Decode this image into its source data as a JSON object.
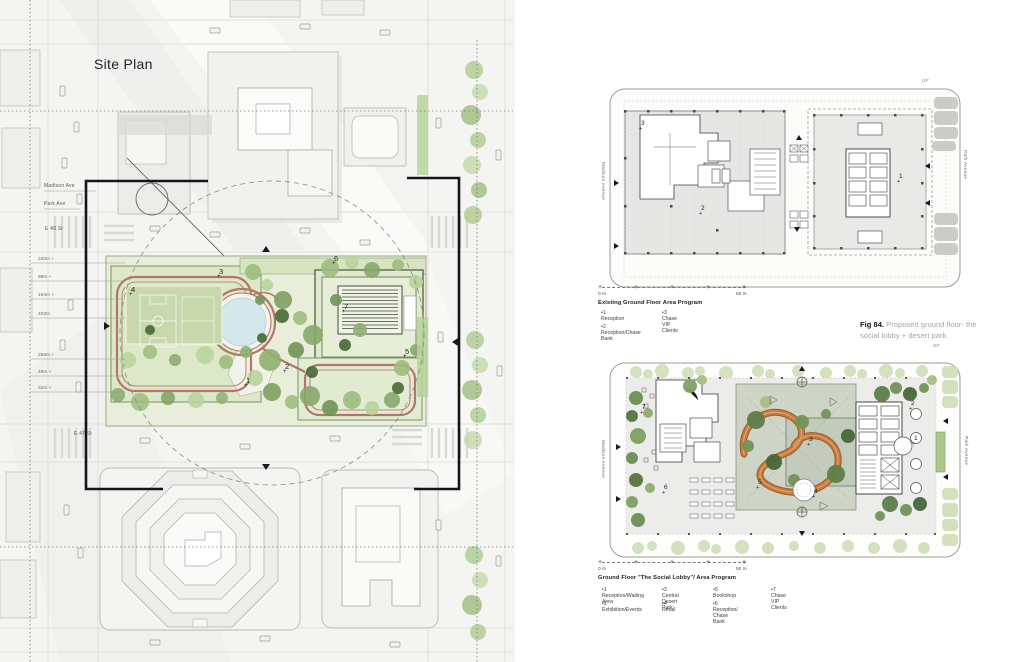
{
  "site_plan": {
    "title": "Site Plan",
    "streets": {
      "madison_ave": "Madison Ave",
      "park_ave": "Park Ave",
      "e48": "E 48 St",
      "e47": "E 47 St"
    },
    "elevations": [
      "340m +",
      "98m +",
      "164m +",
      "403m",
      "256m +",
      "48m +",
      "32m +"
    ],
    "markers": {
      "m1": "1",
      "m2": "2",
      "m3": "3",
      "m4": "4",
      "m5": "5",
      "m6": "6",
      "m7": "7"
    }
  },
  "existing_plan": {
    "floor_tag": "GF",
    "street_left": "Madison Avenue",
    "street_right": "Park Avenue",
    "markers": {
      "m1": "1",
      "m2": "2",
      "m3": "3"
    },
    "scale_start": "0 m",
    "scale_end": "50 m",
    "caption": "Existing Ground Floor Area Program",
    "legend": {
      "item1": "•1 Reception",
      "item2": "•2 Reception/Chase Bank",
      "item3": "•3 Chase VIP Clients"
    }
  },
  "figure": {
    "label": "Fig 84.",
    "text": " Proposed ground floor- the social lobby + desert park."
  },
  "proposed_plan": {
    "floor_tag": "GF",
    "street_left": "Madison Avenue",
    "street_right": "Park Avenue",
    "markers": {
      "m1": "1",
      "m2": "2",
      "m3": "3",
      "m4": "4",
      "m5": "5",
      "m6": "6",
      "m7": "7"
    },
    "scale_start": "0 m",
    "scale_end": "50 m",
    "caption": "Ground Floor \"The Social Lobby\"/ Area Program",
    "legend_row1": {
      "item1": "•1 Reception/Waiting Area",
      "item3": "•3 Central Desert Park",
      "item5": "•5 Bookshop",
      "item7": "•7 Chase VIP Clients"
    },
    "legend_row2": {
      "item2": "•2 Exhibition/Events",
      "item4": "•4 Retail",
      "item6": "•6 Reception/ Chase Bank"
    }
  },
  "colors": {
    "track": "#b4756c",
    "ramp": "#c57a3f",
    "park_green_light": "#e8eeda",
    "park_green_mid": "#cfdfb7",
    "tree_dark": "#5f814a",
    "pool": "#d4e7ea",
    "ink": "#141414"
  }
}
